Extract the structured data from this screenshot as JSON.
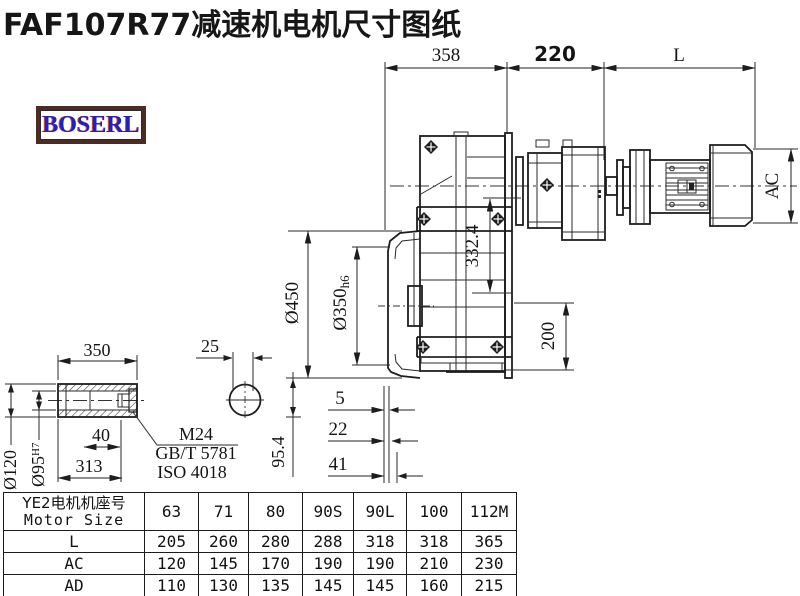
{
  "title": "FAF107R77减速机电机尺寸图纸",
  "logo": {
    "text": "BOSERL"
  },
  "drawing": {
    "dims": {
      "gearbox_width": "358",
      "adapter_length": "220",
      "motor_length": "L",
      "motor_diameter": "AC",
      "center_height": "332.4",
      "flange_diameter": "Ø450",
      "spigot_main": "Ø350",
      "spigot_tol": "h6",
      "offset_200": "200",
      "step_5": "5",
      "step_22": "22",
      "step_41": "41",
      "shaft_center_height": "95.4"
    },
    "shaft_detail": {
      "length_350": "350",
      "width_25": "25",
      "outer_dia": "Ø120",
      "bore_dia": "Ø95",
      "bore_tol": "H7",
      "depth_40": "40",
      "length_313": "313",
      "bolt_label": "M24",
      "standard_gb": "GB/T 5781",
      "standard_iso": "ISO 4018"
    }
  },
  "table": {
    "header_line1": "YE2电机机座号",
    "header_line2": "Motor Size",
    "frame_sizes": [
      "63",
      "71",
      "80",
      "90S",
      "90L",
      "100",
      "112M"
    ],
    "rows": [
      {
        "label": "L",
        "values": [
          "205",
          "260",
          "280",
          "288",
          "318",
          "318",
          "365"
        ]
      },
      {
        "label": "AC",
        "values": [
          "120",
          "145",
          "170",
          "190",
          "190",
          "210",
          "230"
        ]
      },
      {
        "label": "AD",
        "values": [
          "110",
          "130",
          "135",
          "145",
          "145",
          "160",
          "215"
        ]
      }
    ]
  }
}
